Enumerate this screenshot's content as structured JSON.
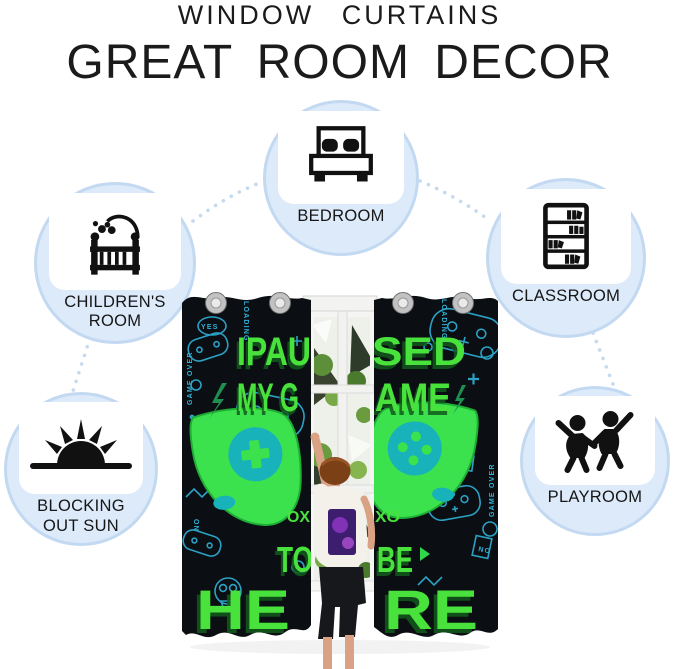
{
  "header": {
    "brand_line": "WINDOW CURTAINS",
    "headline": "GREAT ROOM DECOR"
  },
  "features": [
    {
      "label": "BEDROOM",
      "icon": "bed-icon"
    },
    {
      "label": "CHILDREN'S ROOM",
      "icon": "crib-icon"
    },
    {
      "label": "CLASSROOM",
      "icon": "bookshelf-icon"
    },
    {
      "label": "BLOCKING OUT SUN",
      "icon": "sun-icon"
    },
    {
      "label": "PLAYROOM",
      "icon": "dancing-kids-icon"
    }
  ],
  "product_photo": {
    "description_slogan": "I PAUSED MY GAME TO BE HERE",
    "fragments": {
      "r1_left": "IPAU",
      "r1_right": "SED",
      "r2_left": "MY G",
      "r2_right": "AME",
      "r3_left": "OX",
      "r3_right": "XO",
      "r4_left": "TO",
      "r4_right": "BE",
      "r5_left": "HE",
      "r5_right": "RE"
    },
    "doodle_words": {
      "loading_left": "LOADING",
      "loading_right": "LOADING",
      "yes": "YES",
      "game_over_left": "GAME OVER",
      "game_over_right": "GAME OVER",
      "game": "GAME",
      "no": "NO",
      "on": "ON"
    }
  },
  "colors": {
    "bubble_fill": "#dceafa",
    "bubble_ring": "#c3d9f1",
    "connector_dots": "#c6daef",
    "curtain_black": "#0b0e12",
    "neon_teal": "#2fb2d8",
    "slogan_green": "#49e23c",
    "controller_green": "#3be24e",
    "controller_teal": "#17b2ba"
  }
}
